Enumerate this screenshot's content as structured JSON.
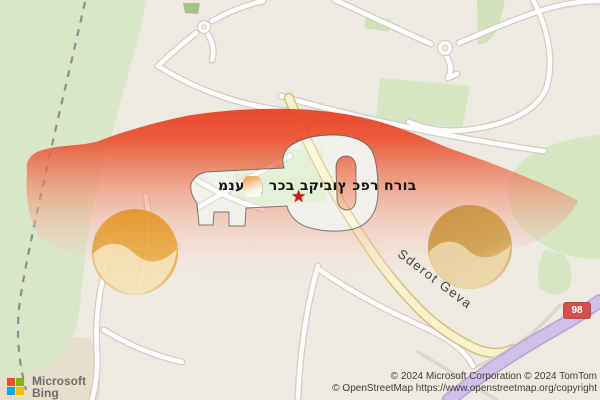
{
  "map": {
    "business_label": "מנעולן רכב בקיבוץ כפר חרוב",
    "road_label": "Sderot Geva",
    "route_badge": "98"
  },
  "branding": {
    "microsoft": "Microsoft",
    "product": "Bing"
  },
  "attribution": {
    "line1": "© 2024 Microsoft Corporation © 2024 TomTom",
    "line2": "© OpenStreetMap https://www.openstreetmap.org/copyright"
  },
  "icons": {
    "location_star": "★",
    "microsoft_logo": "microsoft-four-squares"
  },
  "colors": {
    "car_overlay_red": "#ec4a2c",
    "wheel_orange": "#e09a35",
    "wheel_brown": "#c8913a",
    "route_badge_red": "#d0524b",
    "road_yellow": "#f8f1cd",
    "road_purple": "#d0bfe8",
    "map_green": "#d9e7c8",
    "ms_red": "#f25022",
    "ms_green": "#7fba00",
    "ms_blue": "#00a4ef",
    "ms_yellow": "#ffb900"
  }
}
